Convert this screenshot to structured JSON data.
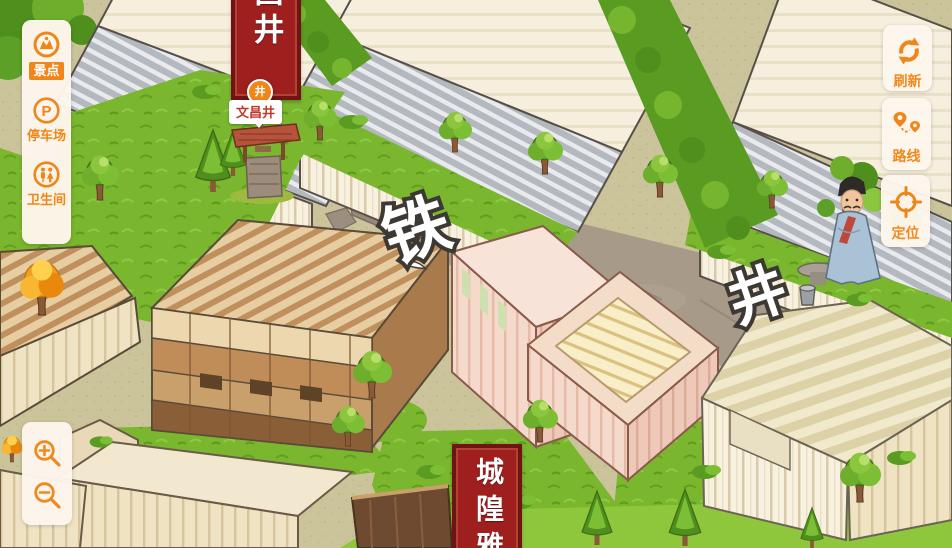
{
  "ui": {
    "accent_color": "#f08519",
    "panel_color": "#fdf6ec",
    "sidebar": {
      "items": [
        {
          "id": "scenic",
          "label": "景点",
          "icon": "scenic-spot-icon",
          "selected": true
        },
        {
          "id": "parking",
          "label": "停车场",
          "icon": "parking-icon",
          "selected": false
        },
        {
          "id": "restroom",
          "label": "卫生间",
          "icon": "restroom-icon",
          "selected": false
        }
      ]
    },
    "map_controls": [
      {
        "id": "refresh",
        "label": "刷新",
        "icon": "refresh-icon"
      },
      {
        "id": "route",
        "label": "路线",
        "icon": "route-icon"
      },
      {
        "id": "locate",
        "label": "定位",
        "icon": "locate-icon"
      }
    ],
    "zoom_controls": {
      "zoom_in_icon": "zoom-in-icon",
      "zoom_out_icon": "zoom-out-icon"
    }
  },
  "map": {
    "street_labels": [
      {
        "text": "铁"
      },
      {
        "text": "井"
      }
    ],
    "poi": {
      "marker_label": "文昌井",
      "marker_glyph": "井"
    },
    "banners": {
      "top": {
        "visible_text": "昌井"
      },
      "bottom": {
        "visible_text": "城隍雅"
      }
    },
    "colors": {
      "ground": "#cbc49b",
      "grass": "#7ab62e",
      "road": "#a89a88",
      "banner_red": "#9e1f1e",
      "roof_gray": "#b9bdc3"
    }
  }
}
